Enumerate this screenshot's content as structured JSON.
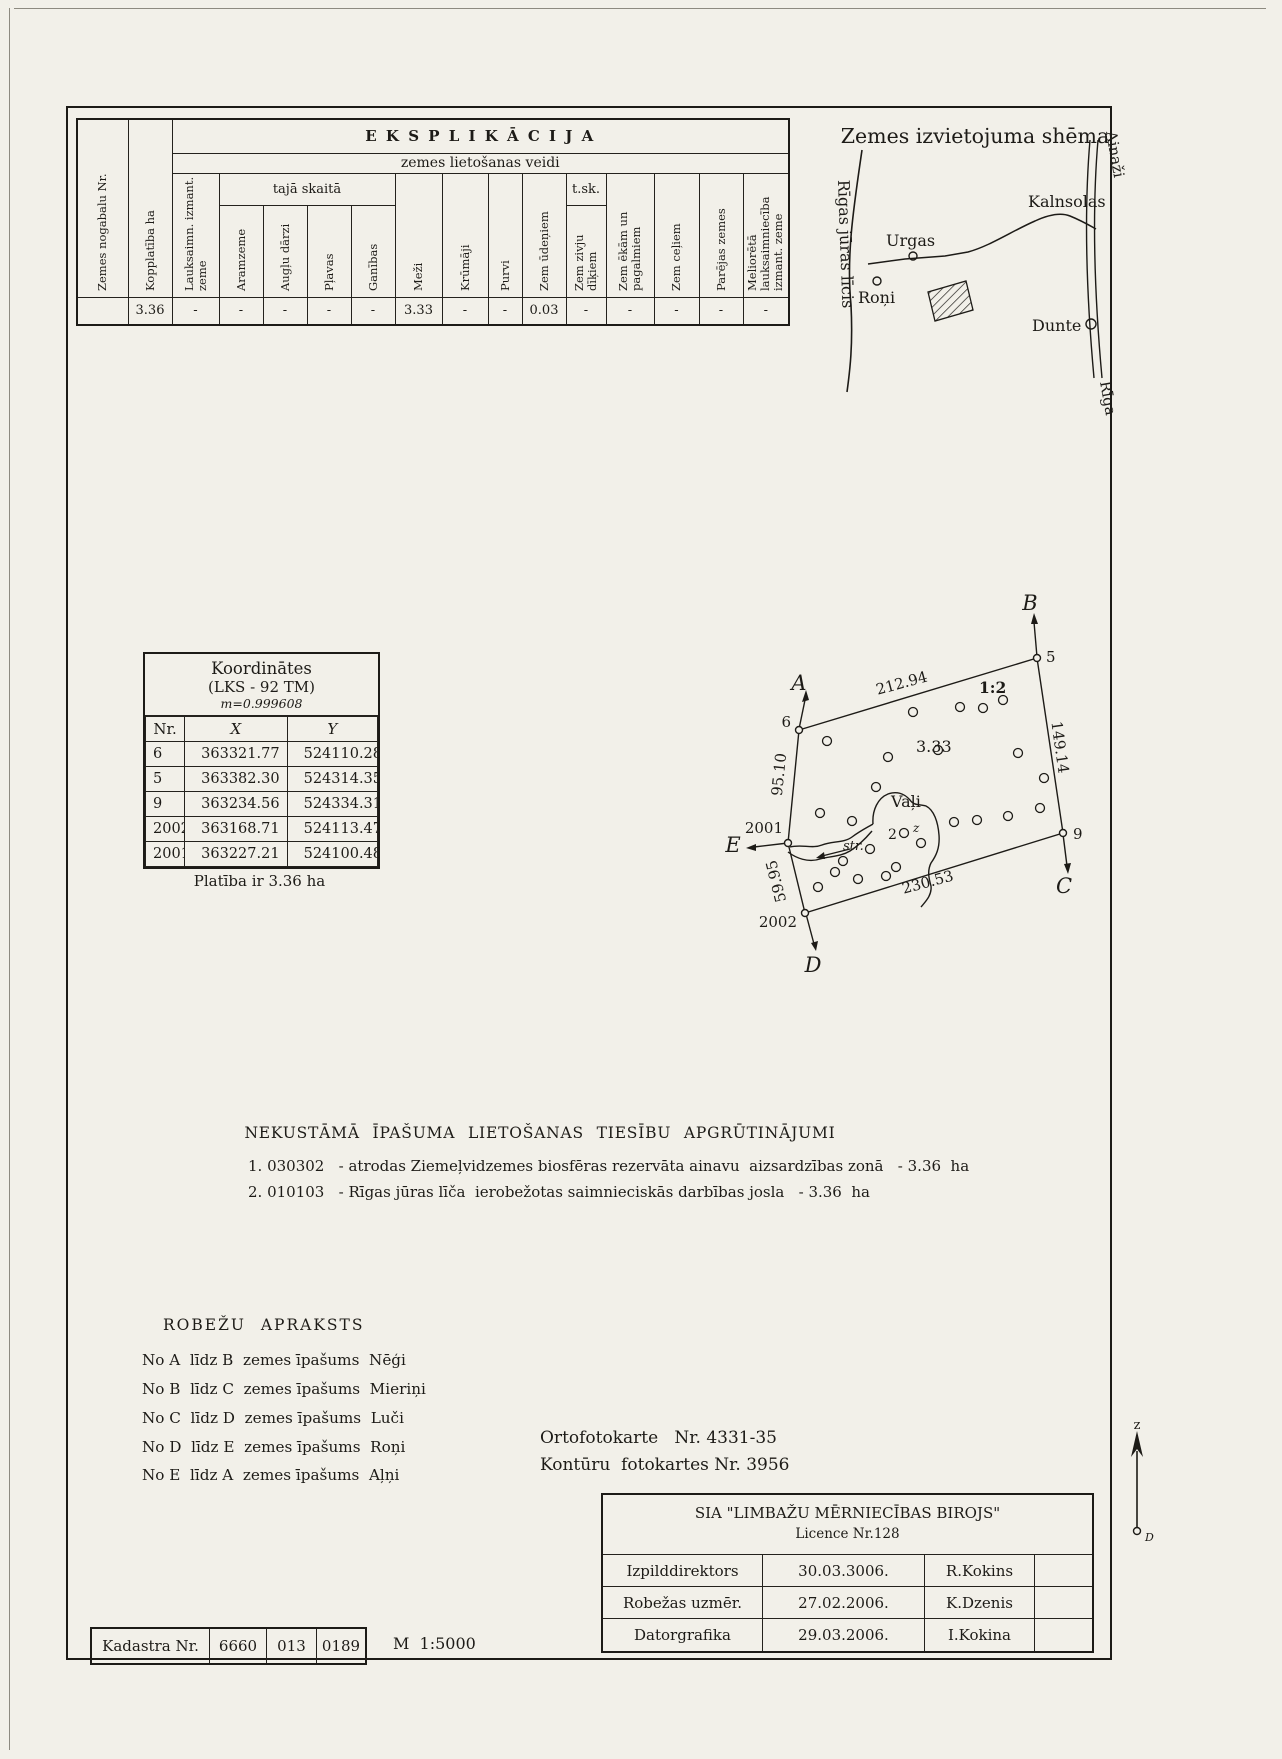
{
  "eksplikacija": {
    "title": "E K S P L I K Ā C I J A",
    "subtitle": "zemes lietošanas veidi",
    "group_taja": "tajā skaitā",
    "group_tsk": "t.sk.",
    "headers": [
      "Zemes nogabalu Nr.",
      "Kopplatība ha",
      "Lauksaimn. izmant. zeme",
      "Aramzeme",
      "Augļu dārzi",
      "Pļavas",
      "Ganības",
      "Meži",
      "Krūmāji",
      "Purvi",
      "Zem ūdeņiem",
      "Zem zivju dīķiem",
      "Zem ēkām un pagalmiem",
      "Zem ceļiem",
      "Parējas zemes",
      "Meliorētā lauksaimniecība izmant. zeme"
    ],
    "values": [
      "",
      "3.36",
      "-",
      "-",
      "-",
      "-",
      "-",
      "3.33",
      "-",
      "-",
      "0.03",
      "-",
      "-",
      "-",
      "-",
      "-"
    ]
  },
  "scheme": {
    "title": "Zemes izvietojuma shēma",
    "gulf": "Rīgas jūras līcis",
    "urgas": "Urgas",
    "kalnsolas": "Kalnsolas",
    "roni": "Roņi",
    "dunte": "Dunte",
    "ainazi": "Ainaži",
    "riga": "Rīga"
  },
  "koordinates": {
    "t1": "Koordinātes",
    "t2": "(LKS - 92 TM)",
    "t3": "m=0.999608",
    "headers": [
      "Nr.",
      "X",
      "Y"
    ],
    "rows": [
      [
        "6",
        "363321.77",
        "524110.28"
      ],
      [
        "5",
        "363382.30",
        "524314.35"
      ],
      [
        "9",
        "363234.56",
        "524334.31"
      ],
      [
        "2002",
        "363168.71",
        "524113.47"
      ],
      [
        "2001",
        "363227.21",
        "524100.48"
      ]
    ],
    "area_note": "Platība ir 3.36 ha"
  },
  "plot": {
    "corner_a": "A",
    "corner_b": "B",
    "corner_c": "C",
    "corner_d": "D",
    "corner_e": "E",
    "pt6": "6",
    "pt5": "5",
    "pt9": "9",
    "pt2001": "2001",
    "pt2002": "2002",
    "m_top": "212.94",
    "m_right": "149.14",
    "m_bottom": "230.53",
    "m_left_upper": "95.10",
    "m_left_lower": "59.95",
    "ratio": "1:2",
    "area": "3.33",
    "name": "Vaļi",
    "stream": "str.",
    "two": "2",
    "z": "z"
  },
  "apgrutinajumi": {
    "heading": "NEKUSTĀMĀ  ĪPAŠUMA  LIETOŠANAS  TIESĪBU  APGRŪTINĀJUMI",
    "items": [
      "1. 030302   - atrodas Ziemeļvidzemes biosfēras rezervāta ainavu  aizsardzības zonā   - 3.36  ha",
      "2. 010103   - Rīgas jūras līča  ierobežotas saimnieciskās darbības josla   - 3.36  ha"
    ]
  },
  "robezas": {
    "heading": "ROBEŽU  APRAKSTS",
    "lines": [
      "No A  līdz B  zemes īpašums  Nēģi",
      "No B  līdz C  zemes īpašums  Mieriņi",
      "No C  līdz D  zemes īpašums  Luči",
      "No D  līdz E  zemes īpašums  Roņi",
      "No E  līdz A  zemes īpašums  Aļņi"
    ]
  },
  "orto": {
    "line1": "Ortofotokarte   Nr. 4331-35",
    "line2": "Kontūru  fotokartes Nr. 3956"
  },
  "firm": {
    "company": "SIA  \"LIMBAŽU  MĒRNIECĪBAS  BIROJS\"",
    "licence": "Licence Nr.128",
    "rows": [
      [
        "Izpilddirektors",
        "30.03.3006.",
        "R.Kokins"
      ],
      [
        "Robežas uzmēr.",
        "27.02.2006.",
        "K.Dzenis"
      ],
      [
        "Datorgrafika",
        "29.03.2006.",
        "I.Kokina"
      ]
    ]
  },
  "kadastra": {
    "label": "Kadastra  Nr.",
    "codes": [
      "6660",
      "013",
      "0189"
    ],
    "scale": "M  1:5000"
  },
  "north": {
    "top": "z",
    "bottom": "D"
  }
}
